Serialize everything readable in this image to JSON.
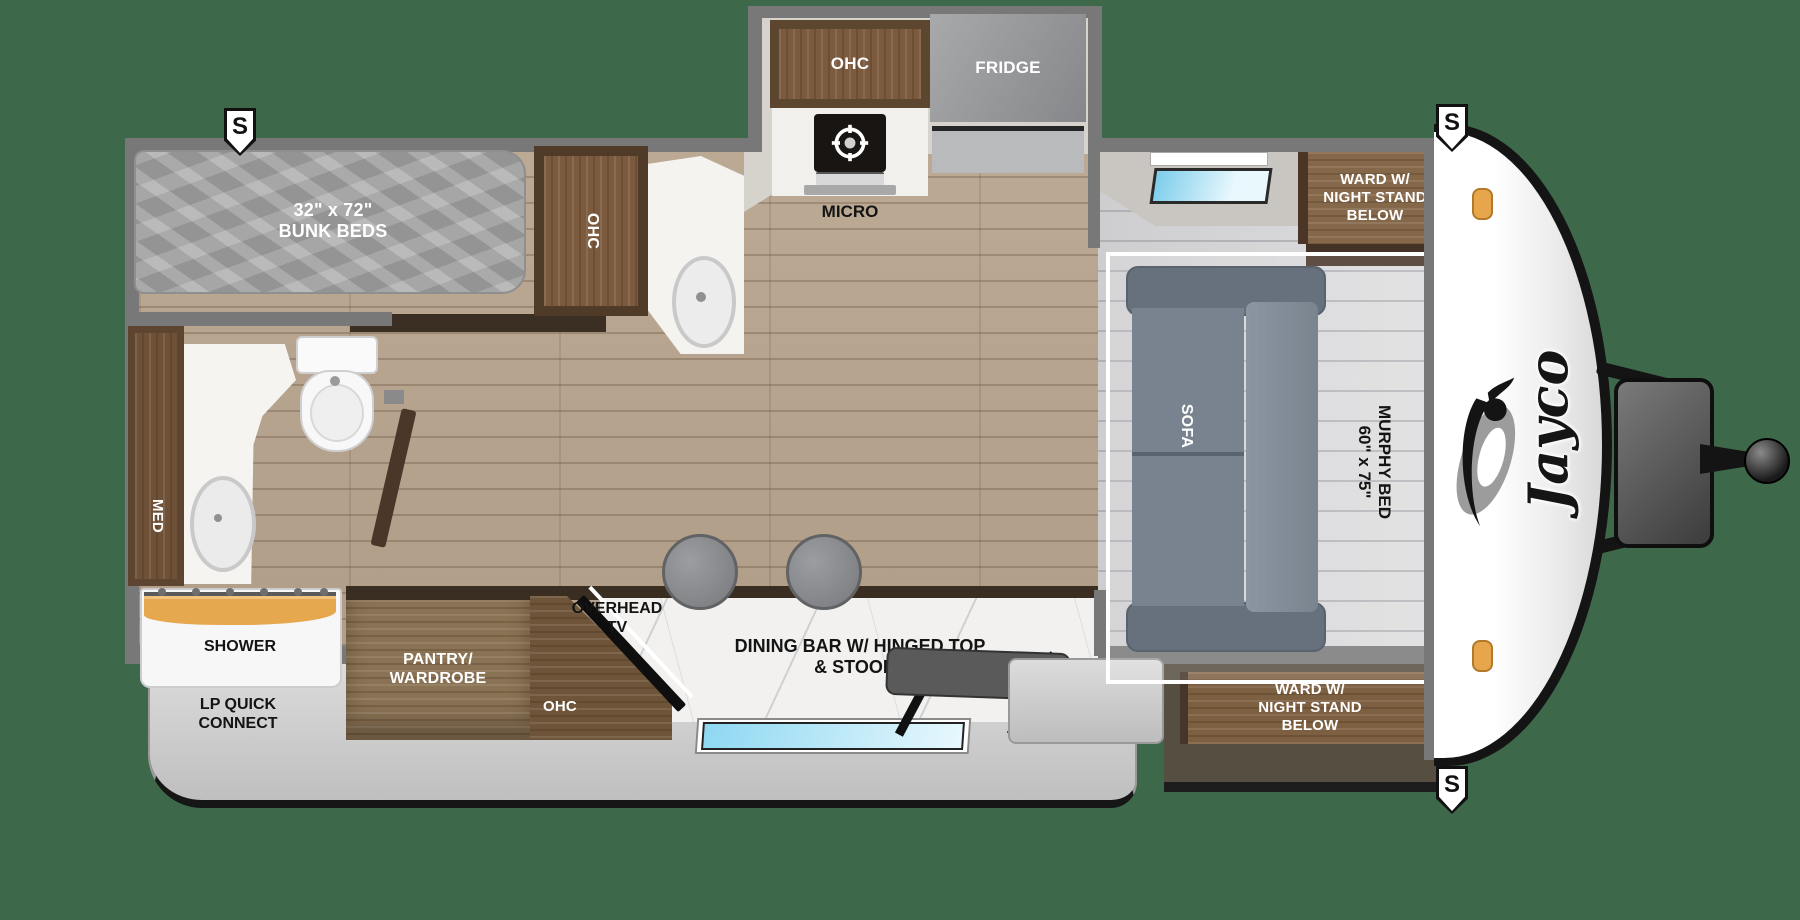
{
  "badges": {
    "speaker": "S"
  },
  "colors": {
    "background": "#3E684A",
    "wall": "#787878",
    "wood_floor": "#B7A48E",
    "tile_floor": "#D9D9DB",
    "cabinet_dark": "#5D4531",
    "cabinet_wood": "#7B5A3E",
    "ward_wood": "#85684A",
    "marble": "#F2F1EF",
    "mattress": "#A6A6A6",
    "sofa": "#78838F",
    "skirt": "#D2D2D2",
    "clearance_light": "#E8A64C",
    "window": "#8ED8F2"
  },
  "bunk_room": {
    "size": "32\" x 72\"",
    "name": "BUNK BEDS"
  },
  "kitchen": {
    "ohc_upper": "OHC",
    "fridge": "FRIDGE",
    "micro": "MICRO",
    "ohc_tall": "OHC"
  },
  "bathroom": {
    "med": "MED",
    "shower": "SHOWER"
  },
  "entertainment": {
    "pantry_l1": "PANTRY/",
    "pantry_l2": "WARDROBE",
    "ohc": "OHC",
    "tv_l1": "OVERHEAD",
    "tv_l2": "TV",
    "dining_l1": "DINING BAR W/ HINGED TOP",
    "dining_l2": "& STOOLS"
  },
  "bedroom": {
    "sofa": "SOFA",
    "murphy_name": "MURPHY BED",
    "murphy_size": "60\" x 75\"",
    "ward_l1": "WARD W/",
    "ward_l2": "NIGHT STAND",
    "ward_l3": "BELOW"
  },
  "exterior": {
    "awning": "15' AWNING",
    "lp_l1": "LP QUICK",
    "lp_l2": "CONNECT",
    "brand": "Jayco"
  }
}
